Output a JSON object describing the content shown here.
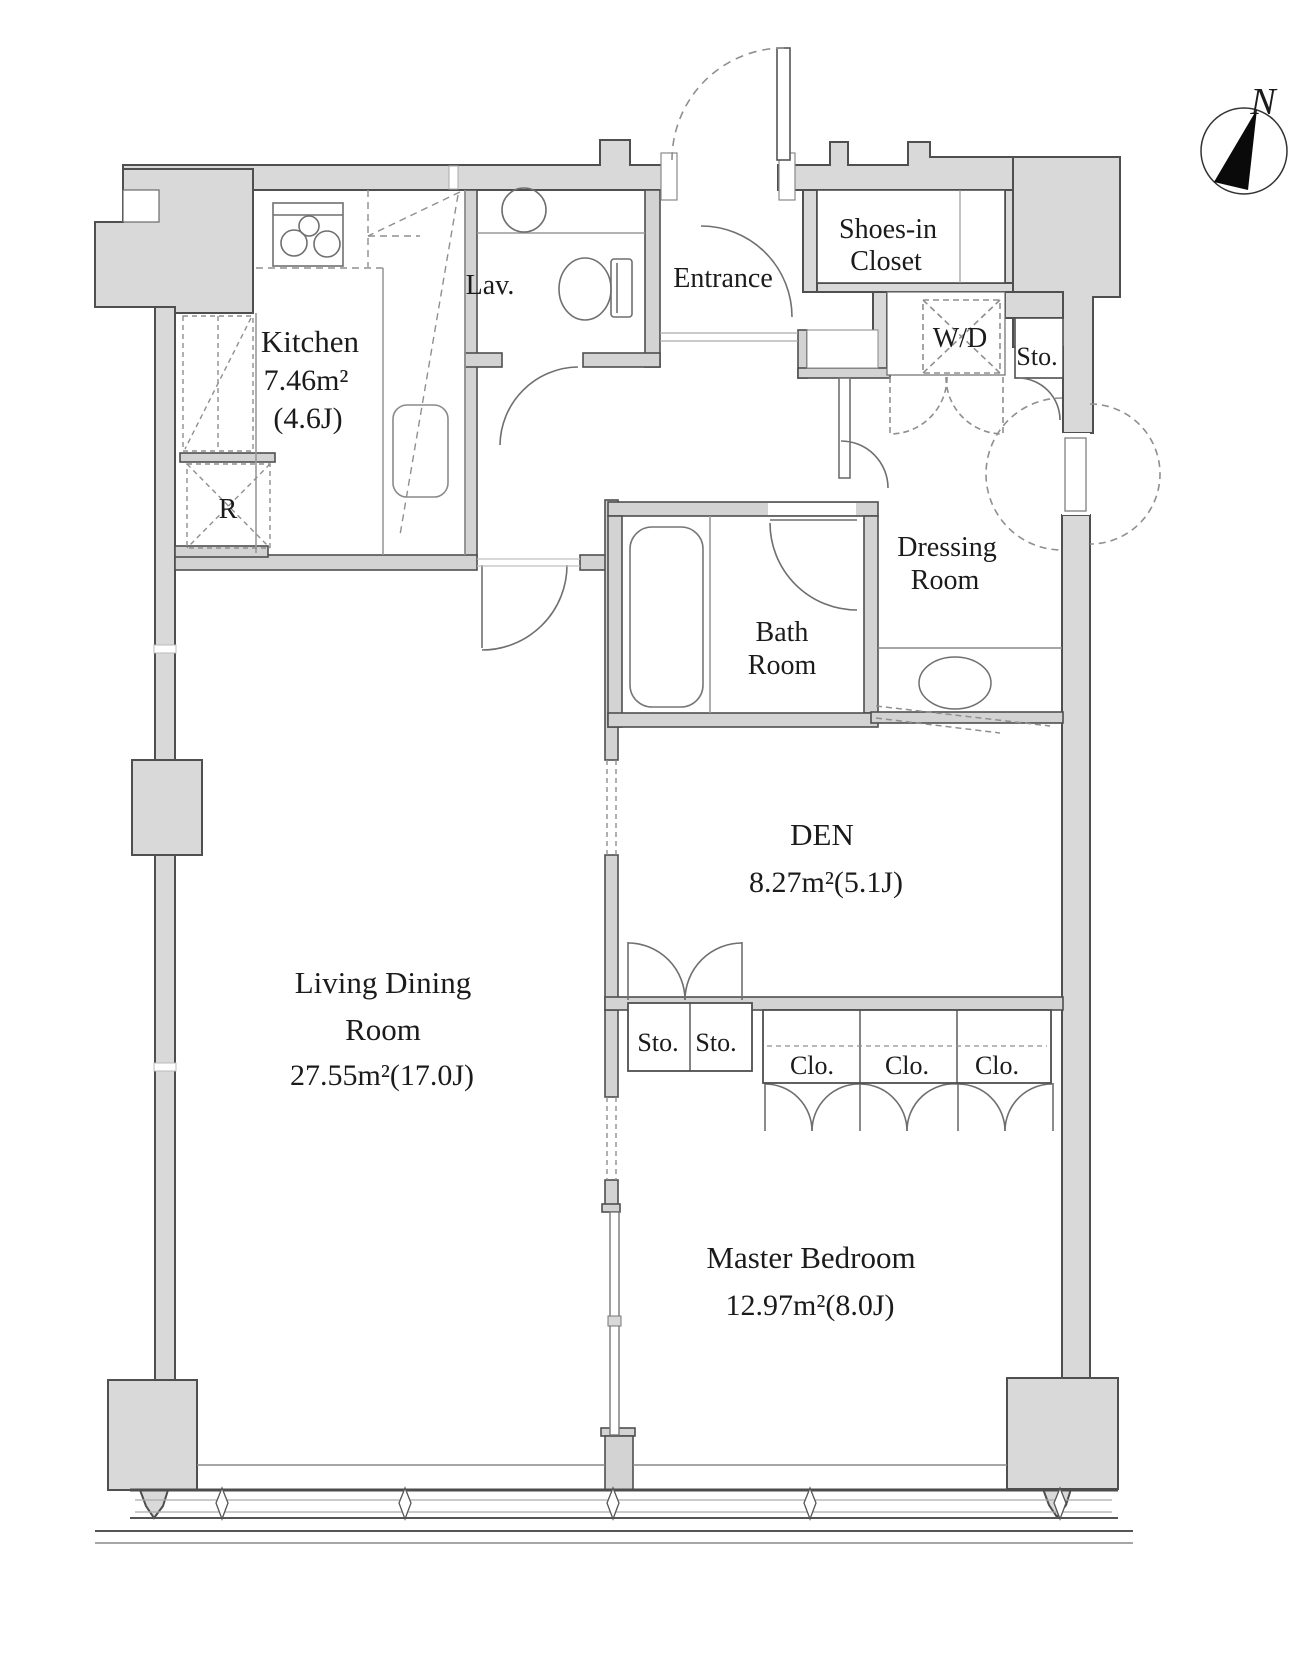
{
  "page": {
    "type": "apartment floor plan",
    "background": "#ffffff"
  },
  "colors": {
    "wall_fill": "#d9d9d9",
    "wall_edge": "#4f4f4f",
    "thin_line": "#777777",
    "dashed_line": "#8f8f8f",
    "text": "#1b1b1b"
  },
  "compass": {
    "label": "N"
  },
  "rooms": {
    "kitchen": {
      "label": "Kitchen",
      "area_m2": "7.46m²",
      "area_j": "(4.6J)"
    },
    "lavatory": {
      "label": "Lav."
    },
    "entrance": {
      "label": "Entrance"
    },
    "shoes_closet": {
      "line1": "Shoes-in",
      "line2": "Closet"
    },
    "washer_dryer": {
      "label": "W/D"
    },
    "hall_storage": {
      "label": "Sto."
    },
    "refrigerator": {
      "label": "R"
    },
    "dressing_room": {
      "line1": "Dressing",
      "line2": "Room"
    },
    "bath_room": {
      "line1": "Bath",
      "line2": "Room"
    },
    "den": {
      "label": "DEN",
      "area": "8.27m²(5.1J)"
    },
    "living_dining": {
      "line1": "Living Dining",
      "line2": "Room",
      "area": "27.55m²(17.0J)"
    },
    "den_storage": {
      "labels": [
        "Sto.",
        "Sto."
      ]
    },
    "bedroom_closets": {
      "labels": [
        "Clo.",
        "Clo.",
        "Clo."
      ]
    },
    "master_bedroom": {
      "label": "Master Bedroom",
      "area": "12.97m²(8.0J)"
    }
  }
}
